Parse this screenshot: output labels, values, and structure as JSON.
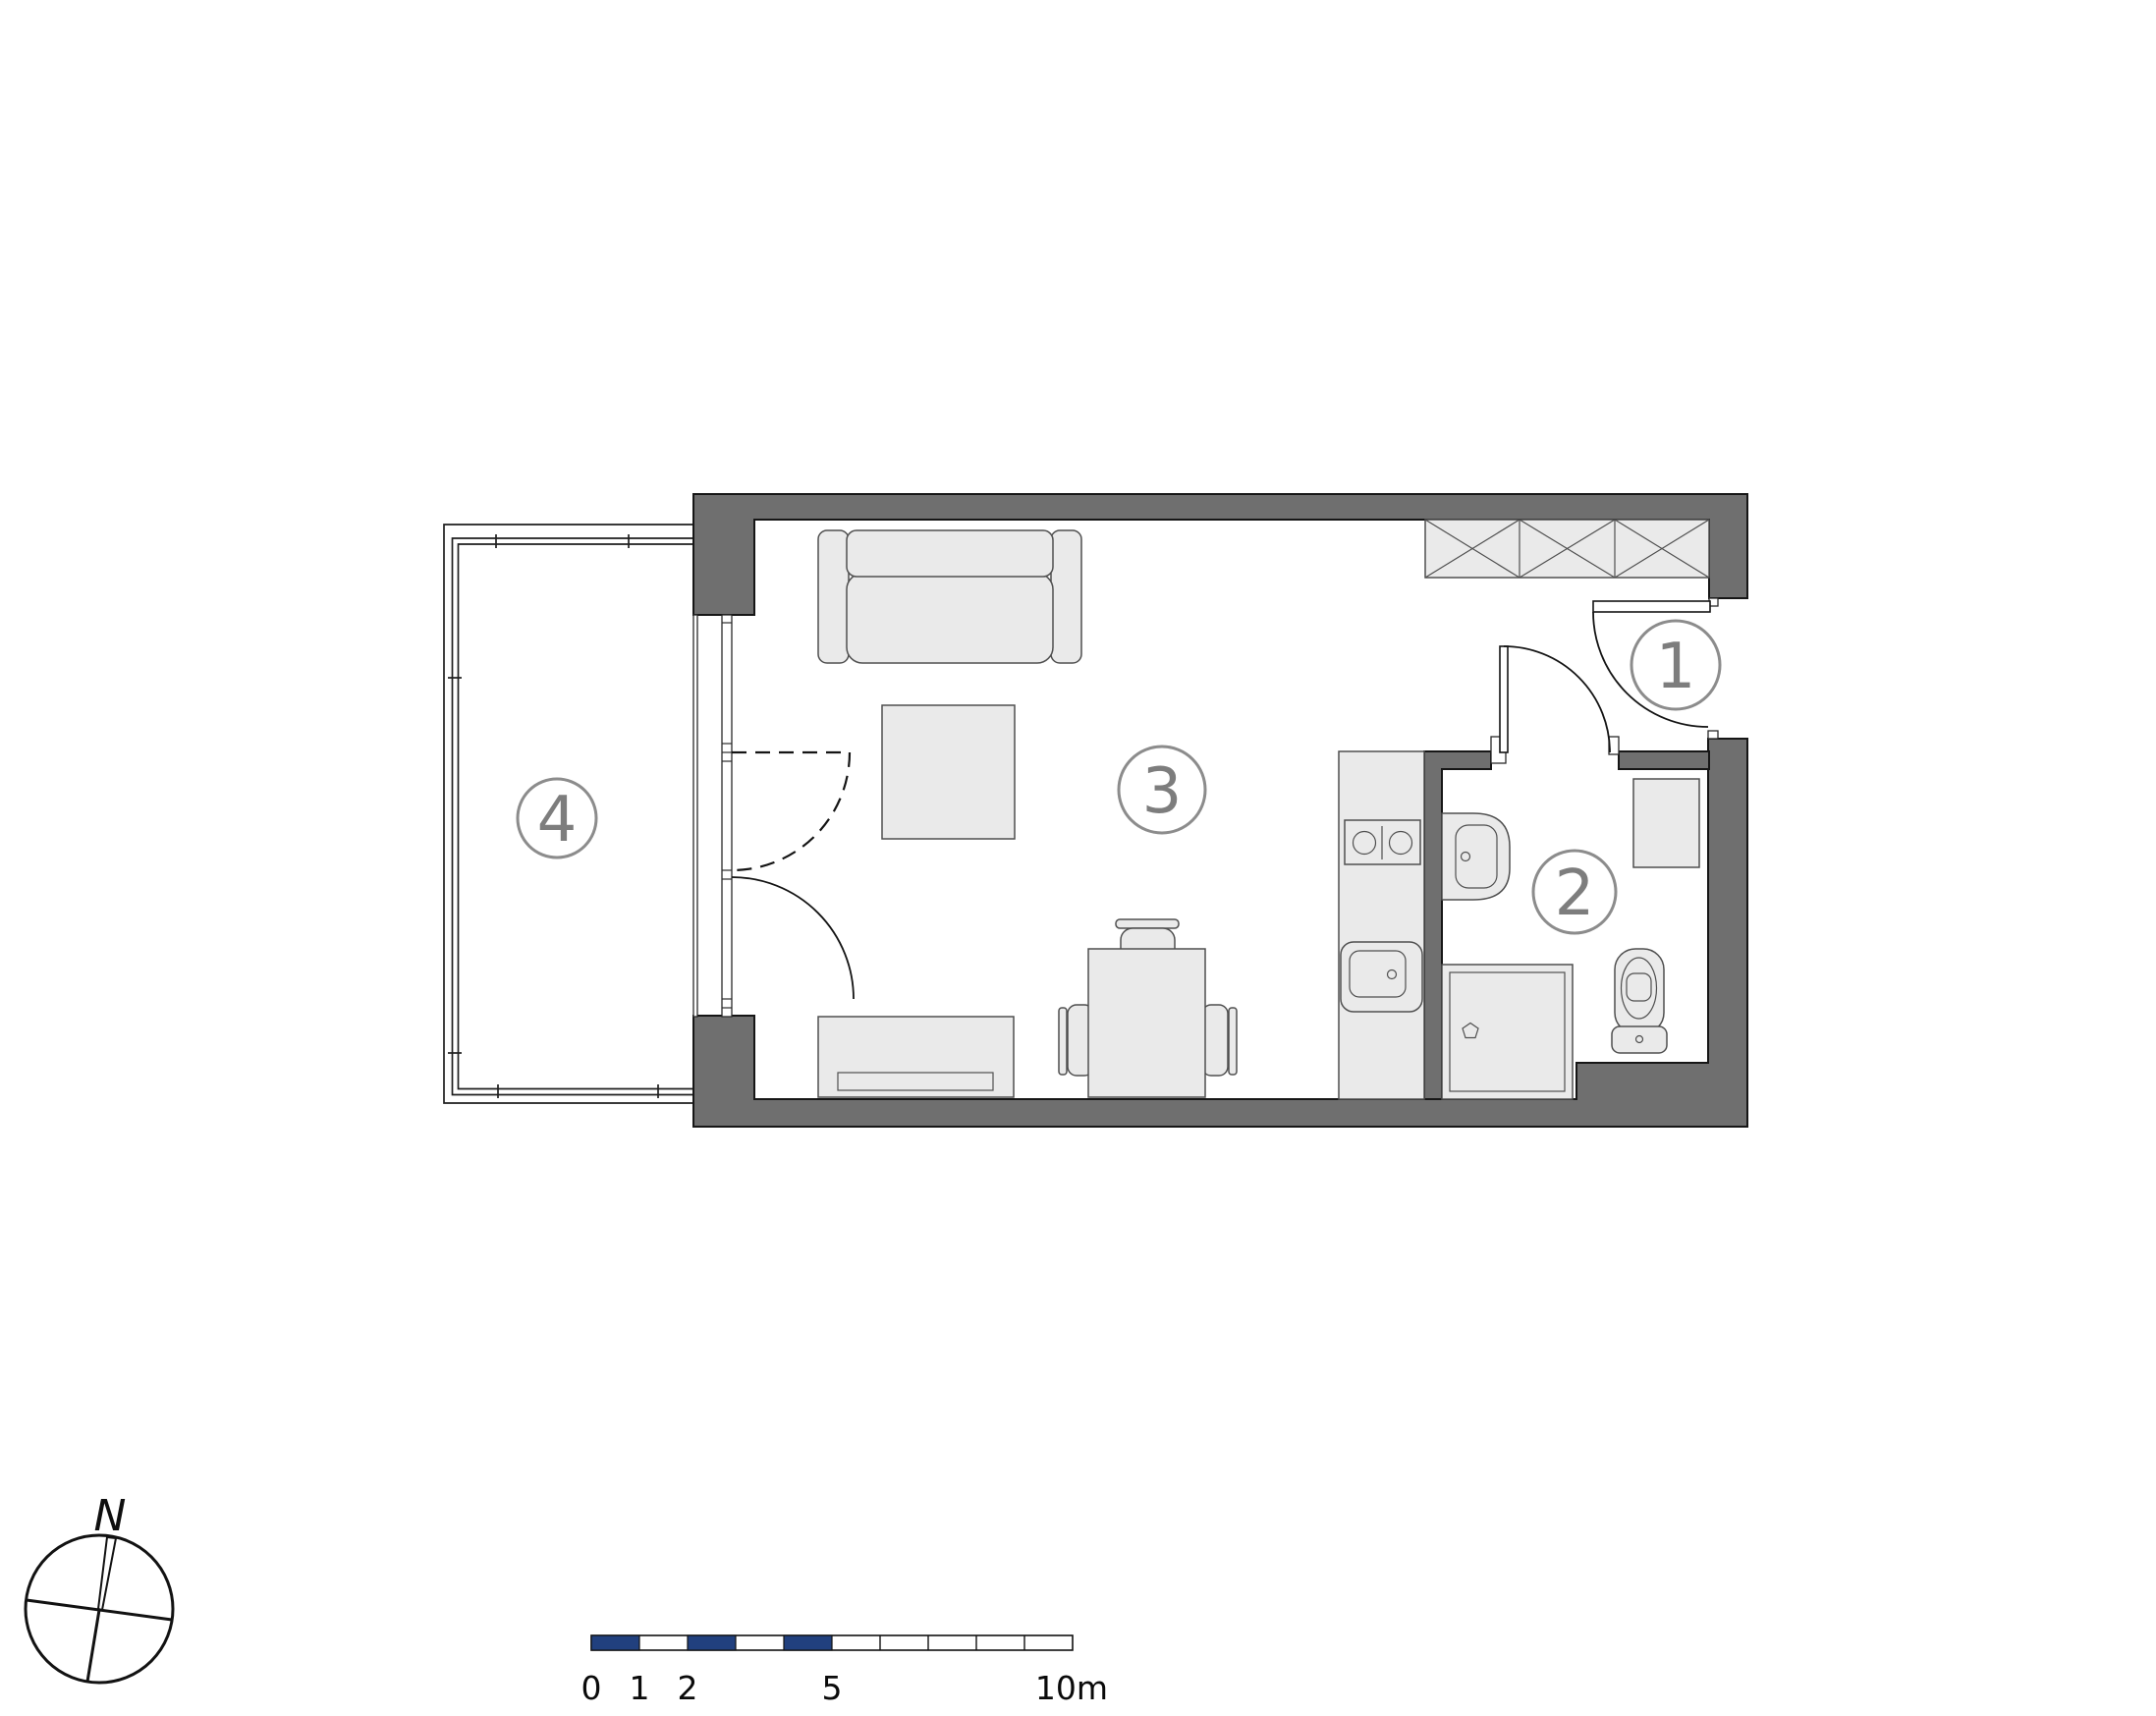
{
  "drawing": {
    "type": "apartment floor plan",
    "room_labels": [
      {
        "id": "room-1-hall",
        "label": "1"
      },
      {
        "id": "room-2-bathroom",
        "label": "2"
      },
      {
        "id": "room-3-living-kitchen",
        "label": "3"
      },
      {
        "id": "room-4-balcony",
        "label": "4"
      }
    ]
  },
  "scale_bar": {
    "labels": [
      "0",
      "1",
      "2",
      "5",
      "10m"
    ]
  },
  "compass": {
    "north_label": "N"
  },
  "colors": {
    "wall_fill": "#6f6f6f",
    "furniture_fill": "#eaeaea",
    "scale_segment_navy": "#21407e",
    "room_label_gray": "#8c8c8c"
  }
}
